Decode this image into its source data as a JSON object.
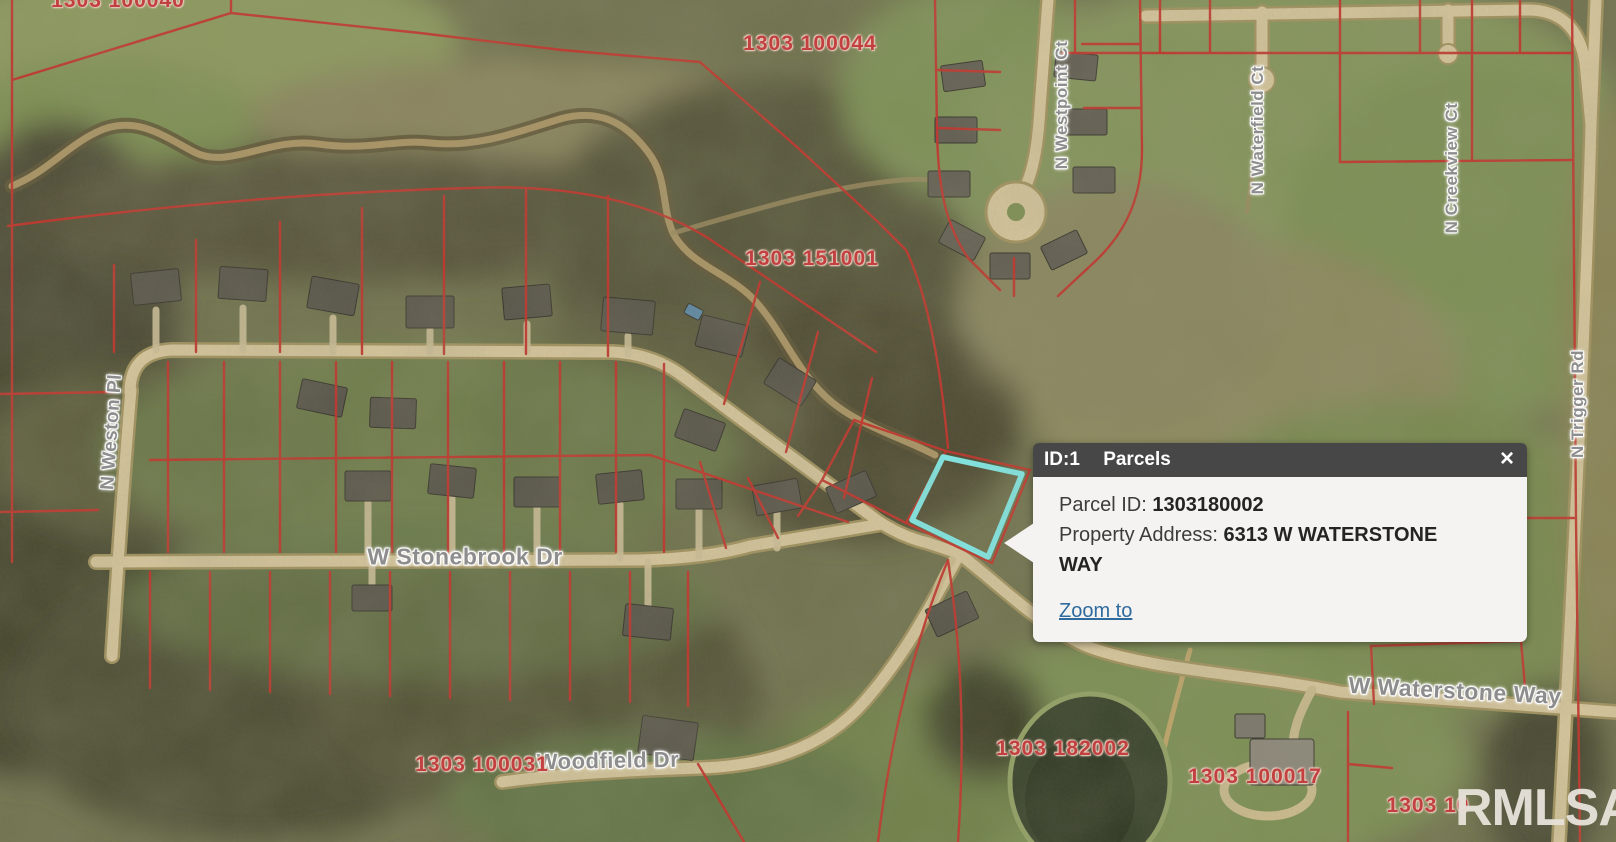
{
  "popup": {
    "id_label": "ID:1",
    "layer_label": "Parcels",
    "close_icon": "×",
    "rows": [
      {
        "label": "Parcel ID: ",
        "value": "1303180002"
      },
      {
        "label": "Property Address: ",
        "value": "6313 W WATERSTONE WAY"
      }
    ],
    "zoom_link": "Zoom to"
  },
  "map": {
    "street_labels": [
      {
        "name": "N Westpoint Ct"
      },
      {
        "name": "N Waterfield Ct"
      },
      {
        "name": "N Creekview Ct"
      },
      {
        "name": "N Trigger Rd"
      },
      {
        "name": "N Weston Pl"
      },
      {
        "name": "W Stonebrook Dr"
      },
      {
        "name": "W Waterstone Way"
      },
      {
        "name": "Woodfield Dr"
      }
    ],
    "parcel_labels": [
      {
        "id": "1303 100040"
      },
      {
        "id": "1303 100044"
      },
      {
        "id": "1303 151001"
      },
      {
        "id": "1303 100031"
      },
      {
        "id": "1303 182002"
      },
      {
        "id": "1303 100017"
      },
      {
        "id": "1303 10"
      }
    ],
    "selected_parcel": {
      "parcel_id": "1303180002"
    },
    "watermark": "RMLSA",
    "colors": {
      "parcel_line": "#c5302a",
      "highlight": "#80ecec",
      "popup_header": "#474747",
      "popup_body": "#f4f3f1",
      "link": "#2f6a9e",
      "parcel_label_text": "#c24040",
      "street_label_text": "#8d8d8d"
    }
  }
}
